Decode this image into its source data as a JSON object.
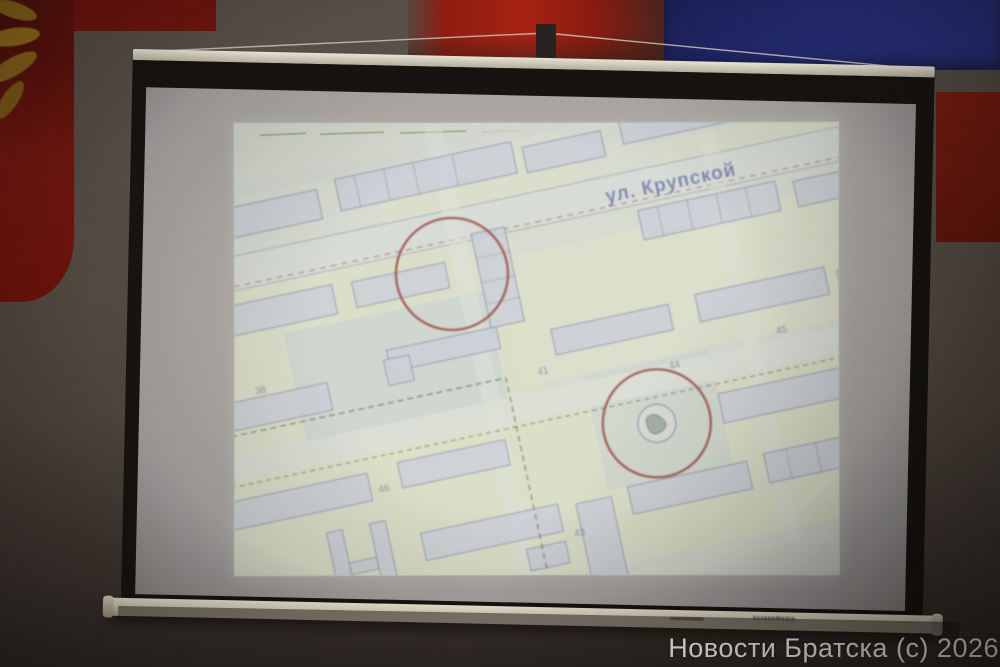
{
  "scene": {
    "description": "Photograph of a conference-hall projection screen showing a city plan with two red circles",
    "wall": {
      "base_color": "#4f4640",
      "dark_bottom": "#2e2824"
    },
    "panels": {
      "left_red": "#701710",
      "top_red": "#a62313",
      "top_blue": "#252c74",
      "right_red": "#6f190e",
      "gold_ornament": "#96721f"
    }
  },
  "screen": {
    "frame_color": "#161310",
    "top_rail_color": "#cfc9b8",
    "bottom_rail_color": "#cdc6b2",
    "surface_color": "#a8a3a0",
    "rail_brand_label": "ScreenMedia"
  },
  "projection": {
    "type": "city plan / cadastral map",
    "paper_color": "#e3e7d9",
    "street_label": "ул. Крупской",
    "street_label_color": "#7282c0",
    "annotation_circle_color": "#b04a42",
    "annotation_circle_count": 2,
    "building_numbers": [
      "41",
      "44",
      "45",
      "43",
      "46",
      "38"
    ]
  },
  "watermark": {
    "text": "Новости Братска (с) 2026",
    "color": "#f7f5f2"
  }
}
